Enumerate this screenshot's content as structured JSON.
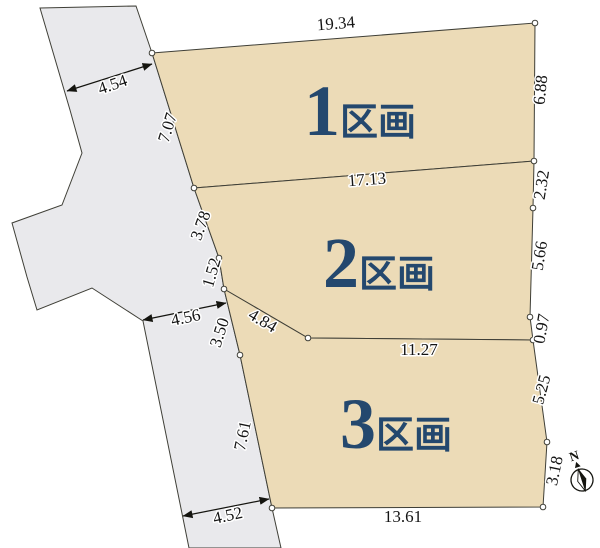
{
  "diagram": {
    "parcels": [
      {
        "number": "1",
        "suffix": "区画"
      },
      {
        "number": "2",
        "suffix": "区画"
      },
      {
        "number": "3",
        "suffix": "区画"
      }
    ],
    "dimensions": {
      "road_width_top": "4.54",
      "parcel1_west": "7.07",
      "parcel1_north": "19.34",
      "parcel1_east": "6.88",
      "parcel1_south": "17.13",
      "parcel2_west_upper": "3.78",
      "parcel2_east_upper": "2.32",
      "parcel2_east_middle": "5.66",
      "parcel2_west_lower": "1.52",
      "parcel2_southwest_diagonal": "4.84",
      "parcel2_east_lower": "0.97",
      "road_width_middle": "4.56",
      "parcel3_west_upper": "3.50",
      "parcel3_north": "11.27",
      "parcel3_east_upper": "5.25",
      "parcel3_west_lower": "7.61",
      "parcel3_east_lower": "3.18",
      "parcel3_south": "13.61",
      "road_width_bottom": "4.52"
    },
    "compass": {
      "north_label": "N"
    },
    "colors": {
      "parcel_fill": "#ecdbb7",
      "road_fill": "#e9e9ec",
      "boundary_line": "#3f3f37",
      "parcel_label_text": "#24486e",
      "dimension_text": "#141414"
    }
  }
}
